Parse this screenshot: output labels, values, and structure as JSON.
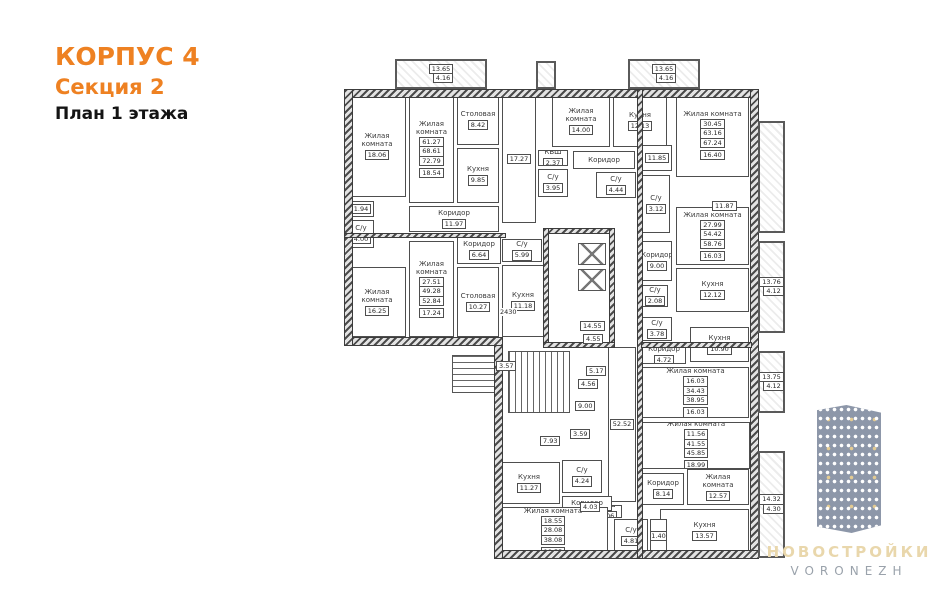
{
  "header": {
    "building": "КОРПУС 4",
    "section": "Секция 2",
    "floor": "План 1 этажа"
  },
  "logo": {
    "title": "НОВОСТРОЙКИ",
    "subtitle": "VORONEZH"
  },
  "colors": {
    "accent": "#ee8122",
    "plan_line": "#4e4e4e",
    "logo_title": "#e9d7ac",
    "logo_subtitle": "#9aa2ab",
    "logo_building": "#8d97a9"
  },
  "plan": {
    "rooms": [
      {
        "label": "Жилая комната",
        "area": "18.06",
        "x": 18,
        "y": 40,
        "w": 58,
        "h": 102
      },
      {
        "label": "Жилая комната",
        "area": "18.54",
        "x": 79,
        "y": 40,
        "w": 45,
        "h": 108,
        "stamp": [
          "61.27",
          "68.61",
          "72.79"
        ]
      },
      {
        "label": "Столовая",
        "area": "8.42",
        "x": 127,
        "y": 40,
        "w": 42,
        "h": 50
      },
      {
        "label": "Кухня",
        "area": "9.85",
        "x": 127,
        "y": 93,
        "w": 42,
        "h": 55
      },
      {
        "label": "Коридор",
        "area": "11.97",
        "x": 79,
        "y": 151,
        "w": 90,
        "h": 26
      },
      {
        "label": "",
        "area": "1.94",
        "x": 18,
        "y": 146,
        "w": 26,
        "h": 16
      },
      {
        "label": "С/у",
        "area": "4.00",
        "x": 18,
        "y": 165,
        "w": 26,
        "h": 28
      },
      {
        "label": "Жилая комната",
        "area": "17.24",
        "x": 79,
        "y": 186,
        "w": 45,
        "h": 96,
        "stamp": [
          "27.51",
          "49.28",
          "52.84"
        ]
      },
      {
        "label": "Столовая",
        "area": "10.27",
        "x": 127,
        "y": 212,
        "w": 42,
        "h": 70
      },
      {
        "label": "Жилая комната",
        "area": "16.25",
        "x": 18,
        "y": 212,
        "w": 58,
        "h": 70
      },
      {
        "label": "Кухня",
        "area": "11.18",
        "x": 172,
        "y": 210,
        "w": 42,
        "h": 72
      },
      {
        "label": "С/у",
        "area": "5.99",
        "x": 172,
        "y": 184,
        "w": 40,
        "h": 23
      },
      {
        "label": "Коридор",
        "area": "6.64",
        "x": 127,
        "y": 181,
        "w": 44,
        "h": 28
      },
      {
        "label": "",
        "area": "17.27",
        "x": 172,
        "y": 40,
        "w": 34,
        "h": 128
      },
      {
        "label": "КВШ",
        "area": "2.37",
        "x": 208,
        "y": 95,
        "w": 30,
        "h": 16
      },
      {
        "label": "С/у",
        "area": "3.95",
        "x": 208,
        "y": 114,
        "w": 30,
        "h": 28
      },
      {
        "label": "Жилая комната",
        "area": "14.00",
        "x": 222,
        "y": 40,
        "w": 58,
        "h": 52
      },
      {
        "label": "Кухня",
        "area": "12.13",
        "x": 283,
        "y": 40,
        "w": 54,
        "h": 52
      },
      {
        "label": "Коридор",
        "area": "",
        "x": 243,
        "y": 96,
        "w": 62,
        "h": 18
      },
      {
        "label": "С/у",
        "area": "4.44",
        "x": 266,
        "y": 117,
        "w": 40,
        "h": 26
      },
      {
        "label": "С/у",
        "area": "3.12",
        "x": 312,
        "y": 120,
        "w": 28,
        "h": 58
      },
      {
        "label": "",
        "area": "11.85",
        "x": 312,
        "y": 90,
        "w": 30,
        "h": 26
      },
      {
        "label": "Жилая комната",
        "area": "16.40",
        "x": 346,
        "y": 38,
        "w": 73,
        "h": 84,
        "stamp": [
          "30.45",
          "63.16",
          "67.24"
        ]
      },
      {
        "label": "Жилая комната",
        "area": "16.03",
        "x": 346,
        "y": 152,
        "w": 73,
        "h": 58,
        "stamp": [
          "27.99",
          "54.42",
          "58.76"
        ]
      },
      {
        "label": "Кухня",
        "area": "12.12",
        "x": 346,
        "y": 213,
        "w": 73,
        "h": 44
      },
      {
        "label": "Коридор",
        "area": "9.00",
        "x": 312,
        "y": 186,
        "w": 30,
        "h": 40
      },
      {
        "label": "С/у",
        "area": "2.08",
        "x": 312,
        "y": 230,
        "w": 26,
        "h": 22
      },
      {
        "label": "С/у",
        "area": "3.78",
        "x": 312,
        "y": 262,
        "w": 30,
        "h": 24
      },
      {
        "label": "Коридор",
        "area": "4.72",
        "x": 312,
        "y": 292,
        "w": 44,
        "h": 17
      },
      {
        "label": "Кухня",
        "area": "10.90",
        "x": 360,
        "y": 272,
        "w": 59,
        "h": 35
      },
      {
        "label": "Жилая комната",
        "area": "16.03",
        "x": 312,
        "y": 312,
        "w": 107,
        "h": 51,
        "stamp": [
          "16.03",
          "34.43",
          "38.95"
        ]
      },
      {
        "label": "Жилая комната",
        "area": "18.99",
        "x": 312,
        "y": 367,
        "w": 108,
        "h": 47,
        "stamp": [
          "11.56",
          "41.55",
          "45.85"
        ]
      },
      {
        "label": "Коридор",
        "area": "8.14",
        "x": 312,
        "y": 418,
        "w": 42,
        "h": 32
      },
      {
        "label": "Жилая комната",
        "area": "12.57",
        "x": 357,
        "y": 414,
        "w": 62,
        "h": 36
      },
      {
        "label": "Кухня",
        "area": "13.57",
        "x": 330,
        "y": 454,
        "w": 89,
        "h": 44
      },
      {
        "label": "С/у",
        "area": "4.81",
        "x": 284,
        "y": 464,
        "w": 34,
        "h": 34
      },
      {
        "label": "",
        "area": "1.40",
        "x": 320,
        "y": 464,
        "w": 17,
        "h": 34
      },
      {
        "label": "КВШ",
        "area": "2.06",
        "x": 262,
        "y": 450,
        "w": 30,
        "h": 13
      },
      {
        "label": "",
        "area": "52.52",
        "x": 278,
        "y": 292,
        "w": 28,
        "h": 155
      },
      {
        "label": "Кухня",
        "area": "11.27",
        "x": 168,
        "y": 407,
        "w": 62,
        "h": 42
      },
      {
        "label": "С/у",
        "area": "4.24",
        "x": 232,
        "y": 405,
        "w": 40,
        "h": 33
      },
      {
        "label": "Коридор",
        "area": "",
        "x": 232,
        "y": 441,
        "w": 50,
        "h": 15
      },
      {
        "label": "Жилая комната",
        "area": "18.55",
        "x": 168,
        "y": 452,
        "w": 110,
        "h": 50,
        "stamp": [
          "18.55",
          "28.08",
          "38.08"
        ]
      }
    ],
    "balconies": [
      {
        "x": 65,
        "y": 4,
        "w": 92,
        "h": 30,
        "stamp": [
          "13.65",
          "4.16"
        ]
      },
      {
        "x": 298,
        "y": 4,
        "w": 72,
        "h": 30,
        "stamp": [
          "13.65",
          "4.16"
        ]
      },
      {
        "x": 206,
        "y": 6,
        "w": 20,
        "h": 28,
        "stamp": null
      },
      {
        "x": 428,
        "y": 66,
        "w": 27,
        "h": 112,
        "stamp": null
      },
      {
        "x": 428,
        "y": 186,
        "w": 27,
        "h": 92,
        "stamp": [
          "13.76",
          "4.12"
        ]
      },
      {
        "x": 428,
        "y": 296,
        "w": 27,
        "h": 62,
        "stamp": [
          "13.75",
          "4.12"
        ]
      },
      {
        "x": 428,
        "y": 396,
        "w": 27,
        "h": 107,
        "stamp": [
          "14.32",
          "4.30"
        ]
      }
    ],
    "dims": [
      {
        "t": "2430",
        "x": 170,
        "y": 253,
        "boxed": false
      },
      {
        "t": "14.55",
        "x": 250,
        "y": 266,
        "boxed": true
      },
      {
        "t": "4.55",
        "x": 253,
        "y": 279,
        "boxed": true
      },
      {
        "t": "5.17",
        "x": 256,
        "y": 311,
        "boxed": true
      },
      {
        "t": "4.56",
        "x": 248,
        "y": 324,
        "boxed": true
      },
      {
        "t": "9.00",
        "x": 245,
        "y": 346,
        "boxed": true
      },
      {
        "t": "3.59",
        "x": 240,
        "y": 374,
        "boxed": true
      },
      {
        "t": "7.93",
        "x": 210,
        "y": 381,
        "boxed": true
      },
      {
        "t": "3.57",
        "x": 166,
        "y": 306,
        "boxed": true
      },
      {
        "t": "4.03",
        "x": 250,
        "y": 447,
        "boxed": true
      },
      {
        "t": "11.87",
        "x": 382,
        "y": 146,
        "boxed": true
      }
    ],
    "walls": [
      {
        "x": 15,
        "y": 35,
        "w": 413,
        "h": 7
      },
      {
        "x": 421,
        "y": 35,
        "w": 7,
        "h": 468
      },
      {
        "x": 165,
        "y": 496,
        "w": 263,
        "h": 7
      },
      {
        "x": 165,
        "y": 290,
        "w": 7,
        "h": 213
      },
      {
        "x": 15,
        "y": 283,
        "w": 157,
        "h": 7
      },
      {
        "x": 15,
        "y": 35,
        "w": 7,
        "h": 255
      },
      {
        "x": 308,
        "y": 35,
        "w": 4,
        "h": 468
      },
      {
        "x": 214,
        "y": 174,
        "w": 70,
        "h": 4
      },
      {
        "x": 214,
        "y": 174,
        "w": 4,
        "h": 118
      },
      {
        "x": 280,
        "y": 174,
        "w": 4,
        "h": 118
      },
      {
        "x": 214,
        "y": 288,
        "w": 70,
        "h": 4
      },
      {
        "x": 15,
        "y": 179,
        "w": 160,
        "h": 3
      },
      {
        "x": 312,
        "y": 288,
        "w": 109,
        "h": 4
      }
    ],
    "stairs": [
      {
        "x": 178,
        "y": 296,
        "w": 62,
        "h": 62,
        "dir": "h"
      },
      {
        "x": 122,
        "y": 300,
        "w": 44,
        "h": 38,
        "dir": "v"
      }
    ],
    "elevators": [
      {
        "x": 248,
        "y": 188,
        "w": 28,
        "h": 22
      },
      {
        "x": 248,
        "y": 214,
        "w": 28,
        "h": 22
      }
    ]
  }
}
